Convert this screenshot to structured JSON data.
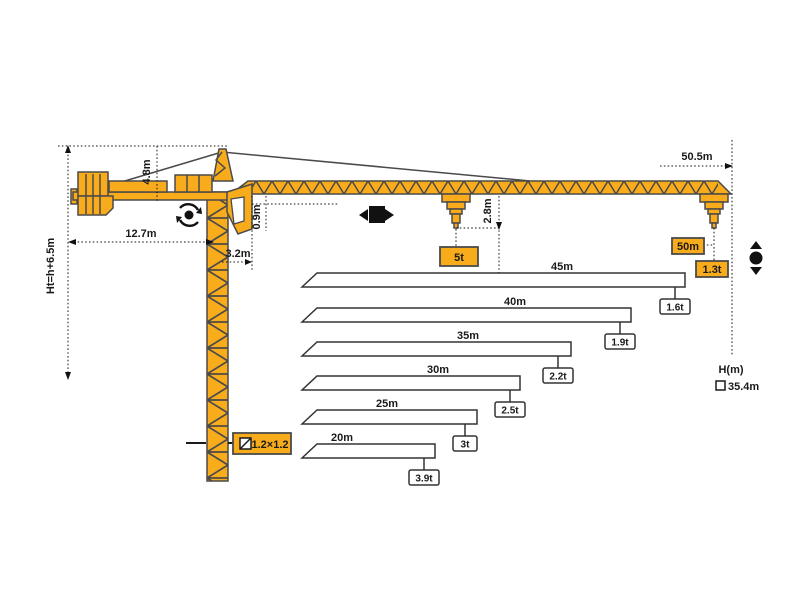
{
  "diagram": {
    "type": "tower-crane-load-diagram",
    "colors": {
      "crane_yellow": "#F8AC1C",
      "crane_outline": "#4a4a4a",
      "dim_line": "#1a1a1a",
      "bar_outline": "#333333",
      "bar_fill": "#ffffff"
    },
    "crane": {
      "dims": {
        "total_height": "Ht=h+6.5m",
        "counter_jib_length": "12.7m",
        "head_height": "4.8m",
        "slew_offset": "3.2m",
        "jib_underside_clearance": "0.9m",
        "tip_hook_drop": "2.8m",
        "max_radius": "50.5m",
        "mast_section": "1.2×1.2"
      },
      "labels": {
        "max_capacity": "5t",
        "tip_radius": "50m",
        "tip_capacity": "1.3t",
        "hook_height_axis": "H(m)",
        "hook_height_value": "35.4m"
      },
      "icons": [
        "slewing-icon",
        "trolley-travel-icon",
        "hoisting-icon",
        "section-symbol-icon"
      ]
    },
    "chart_data": {
      "type": "bar",
      "title": "Jib length vs. tip load capacity",
      "categories": [
        "45m",
        "40m",
        "35m",
        "30m",
        "25m",
        "20m"
      ],
      "values_t": [
        1.6,
        1.9,
        2.2,
        2.5,
        3,
        3.9
      ],
      "bars": [
        {
          "length": "45m",
          "capacity": "1.6t",
          "px_right": 685,
          "px_top": 273,
          "label_x": 562,
          "box_x": 675
        },
        {
          "length": "40m",
          "capacity": "1.9t",
          "px_right": 631,
          "px_top": 308,
          "label_x": 515,
          "box_x": 620
        },
        {
          "length": "35m",
          "capacity": "2.2t",
          "px_right": 571,
          "px_top": 342,
          "label_x": 468,
          "box_x": 558
        },
        {
          "length": "30m",
          "capacity": "2.5t",
          "px_right": 520,
          "px_top": 376,
          "label_x": 438,
          "box_x": 510
        },
        {
          "length": "25m",
          "capacity": "3t",
          "px_right": 477,
          "px_top": 410,
          "label_x": 387,
          "box_x": 465
        },
        {
          "length": "20m",
          "capacity": "3.9t",
          "px_right": 435,
          "px_top": 444,
          "label_x": 342,
          "box_x": 424
        }
      ],
      "px_left_bottom": 302,
      "px_left_top": 317,
      "bar_height": 14,
      "legend_position": "none",
      "grid": false
    }
  }
}
